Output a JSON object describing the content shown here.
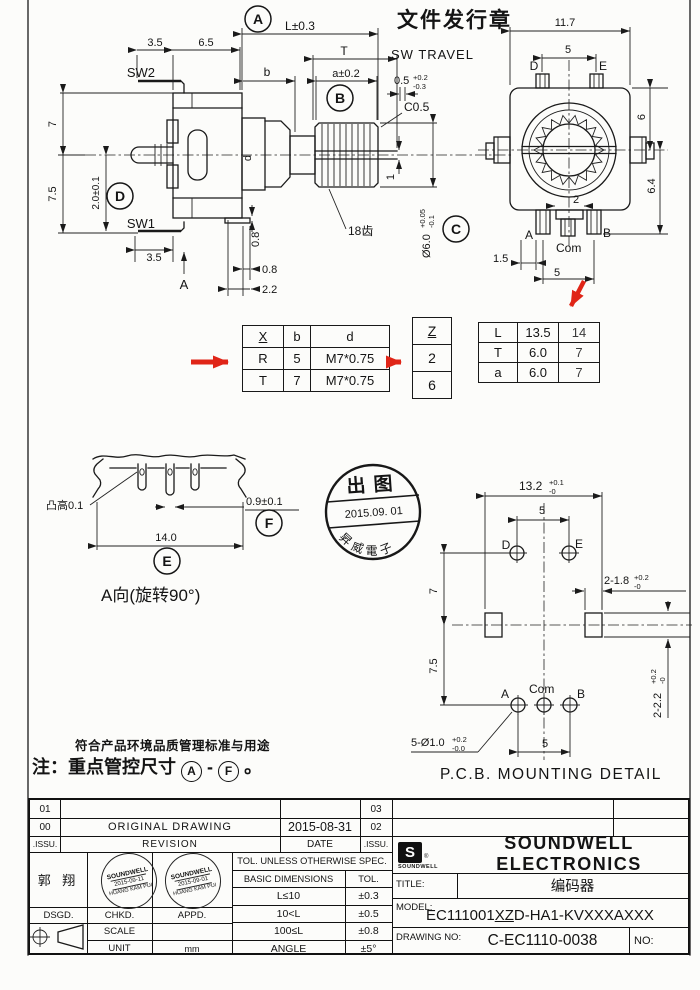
{
  "drawing": {
    "header_stamp": "文件发行章",
    "side_view": {
      "sw_travel_label": "SW TRAVEL",
      "dim_l": "L±0.3",
      "dim_t": "T",
      "dim_b": "b",
      "dim_a": "a±0.2",
      "travel_main": "0.5",
      "travel_sup": "+0.2",
      "travel_sub": "-0.3",
      "chamfer": "C0.5",
      "dim_35_top": "3.5",
      "dim_65": "6.5",
      "sw2": "SW2",
      "dim_7": "7",
      "dim_75": "7.5",
      "dim_20": "2.0±0.1",
      "sw1": "SW1",
      "dim_35_bot": "3.5",
      "view_a": "A",
      "teeth": "18齿",
      "dia_main": "Ø6.0",
      "dia_sup": "+0.05",
      "dia_sub": "-0.1",
      "dim_1": "1",
      "dim_d": "d",
      "dim_08v": "0.8",
      "dim_08h": "0.8",
      "dim_22": "2.2"
    },
    "front_view": {
      "dim_117": "11.7",
      "dim_5_top": "5",
      "d": "D",
      "e": "E",
      "dim_6": "6",
      "dim_64": "6.4",
      "dim_2": "2",
      "a": "A",
      "com": "Com",
      "b": "B",
      "dim_15": "1.5",
      "dim_5_bot": "5"
    },
    "callouts": {
      "a": "A",
      "b": "B",
      "c": "C",
      "d": "D",
      "e": "E",
      "f": "F"
    },
    "spec_table": {
      "headers": [
        "X",
        "b",
        "d"
      ],
      "rows": [
        [
          "R",
          "5",
          "M7*0.75"
        ],
        [
          "T",
          "7",
          "M7*0.75"
        ]
      ]
    },
    "z_table": {
      "header": "Z",
      "values": [
        "2",
        "6"
      ]
    },
    "lta_table": {
      "rows": [
        [
          "L",
          "13.5",
          "14"
        ],
        [
          "T",
          "6.0",
          "7"
        ],
        [
          "a",
          "6.0",
          "7"
        ]
      ]
    },
    "a_view": {
      "bump": "凸高0.1",
      "dim_09": "0.9±0.1",
      "dim_14": "14.0",
      "caption": "A向(旋转90°)"
    },
    "release_stamp": {
      "line1": "出图",
      "line2": "2015.09. 01",
      "line3": "昇威電子"
    },
    "pcb": {
      "dim_132": "13.2",
      "dim_132_sup": "+0.1",
      "dim_132_sub": "-0",
      "dim_5_top": "5",
      "d": "D",
      "e": "E",
      "dim_7": "7",
      "dim_75": "7.5",
      "slot_w": "2-1.8",
      "slot_w_sup": "+0.2",
      "slot_w_sub": "-0",
      "slot_h": "2-2.2",
      "slot_h_sup": "+0.2",
      "slot_h_sub": "-0",
      "a": "A",
      "com": "Com",
      "b": "B",
      "holes": "5-Ø1.0",
      "holes_sup": "+0.2",
      "holes_sub": "-0.0",
      "dim_5_bot": "5",
      "caption": "P.C.B. MOUNTING DETAIL"
    },
    "notes": {
      "line1": "符合产品环境品质管理标准与用途",
      "line2_prefix": "注：重点管控尺寸",
      "range_from": "A",
      "range_to": "F",
      "line2_suffix": "。"
    }
  },
  "title_block": {
    "revisions": {
      "rows": [
        {
          "issu_left": "01",
          "desc": "",
          "date": "",
          "issu_right": "03"
        },
        {
          "issu_left": "00",
          "desc": "ORIGINAL  DRAWING",
          "date": "2015-08-31",
          "issu_right": "02"
        }
      ],
      "header": {
        "issu": ".ISSU.",
        "revision": "REVISION",
        "date": "DATE",
        "issu2": ".ISSU."
      }
    },
    "designer": "郭 翔",
    "roles": {
      "dsgd": "DSGD.",
      "chkd": "CHKD.",
      "appd": "APPD."
    },
    "scale_label": "SCALE",
    "unit_label": "UNIT",
    "unit_value": "mm",
    "tolerance": {
      "header": "TOL. UNLESS OTHERWISE  SPEC.",
      "col_dim": "BASIC DIMENSIONS",
      "col_tol": "TOL.",
      "rows": [
        [
          "L≤10",
          "±0.3"
        ],
        [
          "10<L",
          "±0.5"
        ],
        [
          "100≤L",
          "±0.8"
        ],
        [
          "ANGLE",
          "±5°"
        ]
      ]
    },
    "company": {
      "logo_letter": "S",
      "logo_text": "SOUNDWELL",
      "reg": "®",
      "name": "SOUNDWELL ELECTRONICS"
    },
    "title_label": "TITLE:",
    "title_value": "编码器",
    "model_label": "MODEL:",
    "model_pre": "EC111001",
    "model_underlined": "XZ",
    "model_post": "D-HA1-KVXXXAXXX",
    "drawing_no_label": "DRAWING NO:",
    "drawing_no_value": "C-EC1110-0038",
    "no_label": "NO:",
    "approval_stamps": [
      {
        "line1": "SOUNDWELL",
        "line2": "2015-09-11",
        "line3": "HUANG KAM PUI"
      },
      {
        "line1": "SOUNDWELL",
        "line2": "2015-09-01",
        "line3": "HUANG KAM PUI"
      }
    ]
  },
  "colors": {
    "red": "#e02517",
    "line": "#1a1a1a",
    "paper": "#fcfcfa"
  }
}
